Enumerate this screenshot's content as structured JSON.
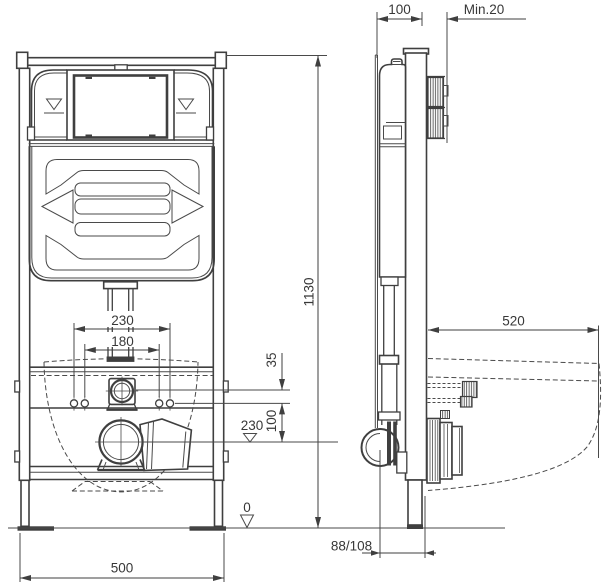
{
  "document": {
    "type": "technical-installation-drawing",
    "subject": "Wall-mounted WC concealed cistern installation frame, front and side elevations",
    "background_color": "#ffffff",
    "line_color": "#3f3f3f",
    "text_color": "#383838"
  },
  "dimensions": {
    "front_view": {
      "frame_height": "1130",
      "frame_width": "500",
      "bolt_spacing_outer": "230",
      "bolt_spacing_inner": "180",
      "inlet_to_bolt_offset": "35",
      "bolt_to_outlet_offset": "100",
      "outlet_height_level": "230",
      "floor_level": "0"
    },
    "side_view": {
      "frame_depth": "100",
      "min_finished_wall": "Min.20",
      "bowl_projection_depth": "520",
      "outlet_wall_offset": "88/108"
    }
  }
}
